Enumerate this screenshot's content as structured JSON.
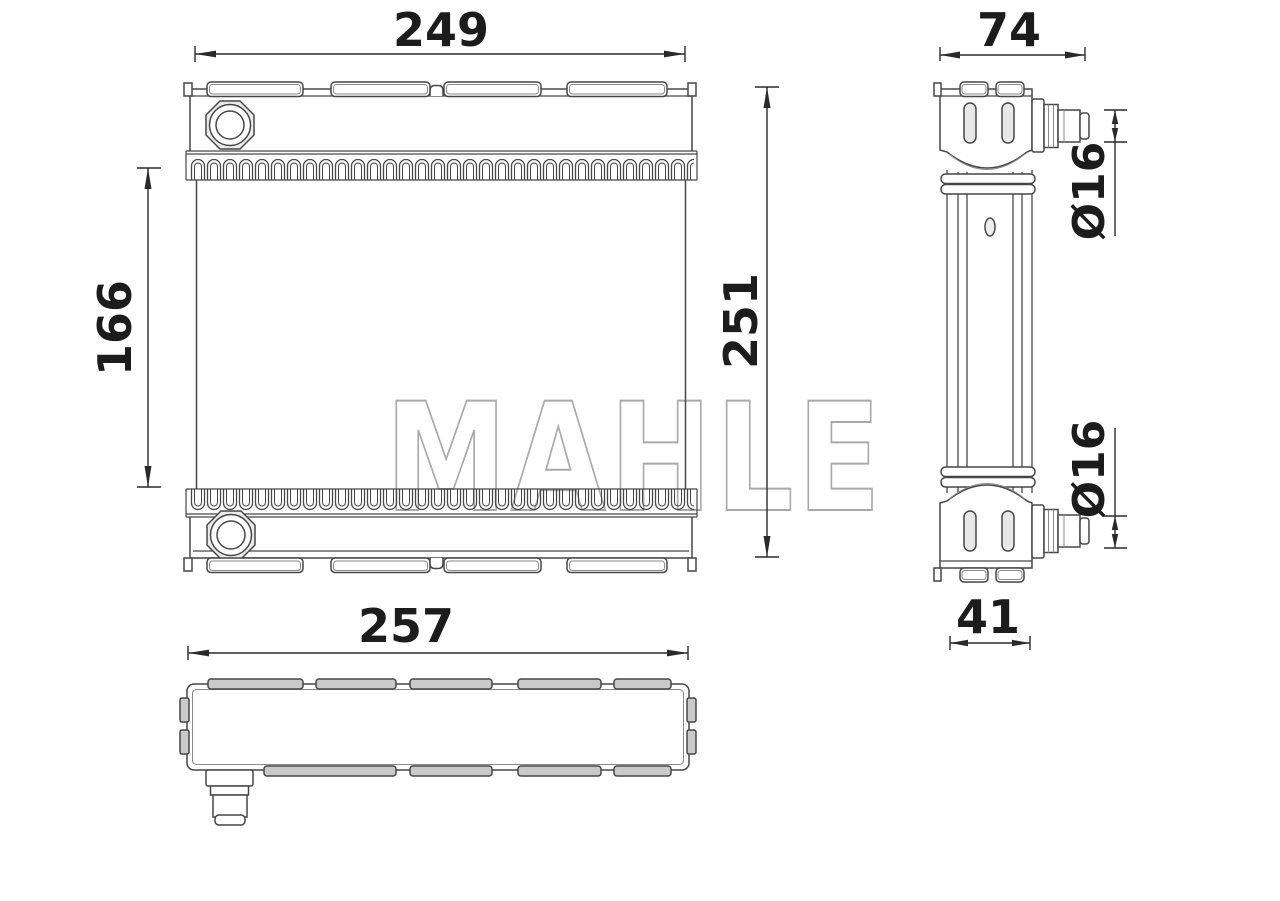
{
  "watermark_text": "MAHLE",
  "drawing_type": "radiator-technical-drawing",
  "dimensions": {
    "front_width": "249",
    "front_core_height": "166",
    "front_height": "251",
    "side_width": "74",
    "side_port_top": "Ø16",
    "side_port_bottom": "Ø16",
    "side_tank_depth": "41",
    "bottom_width": "257"
  },
  "colors": {
    "line": "#474747",
    "secondary_line": "#8a8a8a",
    "dim_text": "#1c1c1c",
    "watermark": "#a9a9a9",
    "tab_fill": "#c9c9c9",
    "shade_fill": "#ececec",
    "background": "#ffffff"
  }
}
